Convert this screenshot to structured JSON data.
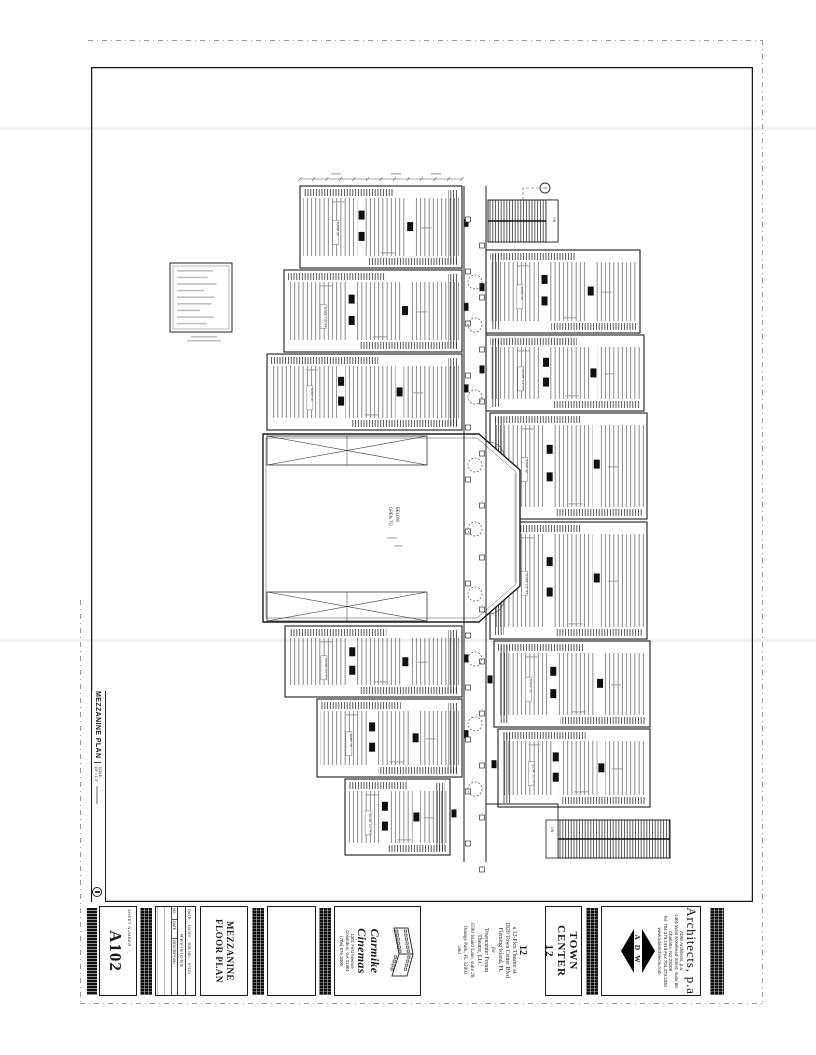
{
  "drawing_titlebar": {
    "title": "MEZZANINE PLAN",
    "scale_label": "SCALE:",
    "scale_value": "1/8\" = 1'-0\""
  },
  "titleblock": {
    "sheet_number": {
      "label": "SHEET NUMBER",
      "value": "A102"
    },
    "revisions": {
      "date_label": "DATE:",
      "date_value": "1/17/07",
      "job_label": "JOB NO.:",
      "job_value": "07121",
      "header": "REVISIONS",
      "columns": [
        "NO.",
        "DATE",
        "DESCRIPTION"
      ]
    },
    "sheet_title_lines": [
      "MEZZANINE",
      "FLOOR PLAN"
    ],
    "carmike": {
      "name": "Carmike Cinemas",
      "address_lines": [
        "1301 First Avenue",
        "Columbus, GA 31901",
        "(706) 576-3400"
      ]
    },
    "project": {
      "number": "12",
      "description_lines": [
        "a 12-Plex Theatre at",
        "1820 Town Center Blvd",
        "Fleming Island, FL"
      ],
      "for_label": "for",
      "client_lines": [
        "Towncenter Forum",
        "Theatre, LLC",
        "1590 Island Lane, suite 28",
        "Orange Park, FL 32003"
      ],
      "and_label": "and"
    },
    "project_title_lines": [
      "TOWN",
      "CENTER",
      "12"
    ],
    "architect": {
      "script_name": "Architects, p.a",
      "logo_letters": "ADW",
      "address_lines": [
        "ADW Architects, p.a.",
        "1401 West Morehead Street, Suite 50",
        "Charlotte, NC 28208",
        "Tel. 704.379.1919  Fax 704.379.1920",
        "www.adwarchitects.com"
      ]
    }
  },
  "plan": {
    "big_room_label_lines": [
      "OPEN TO",
      "BELOW"
    ],
    "ramp_labels": [
      "RAMP UP",
      "SLOPE 1/2\"/FT"
    ],
    "stair_label": "DN"
  }
}
